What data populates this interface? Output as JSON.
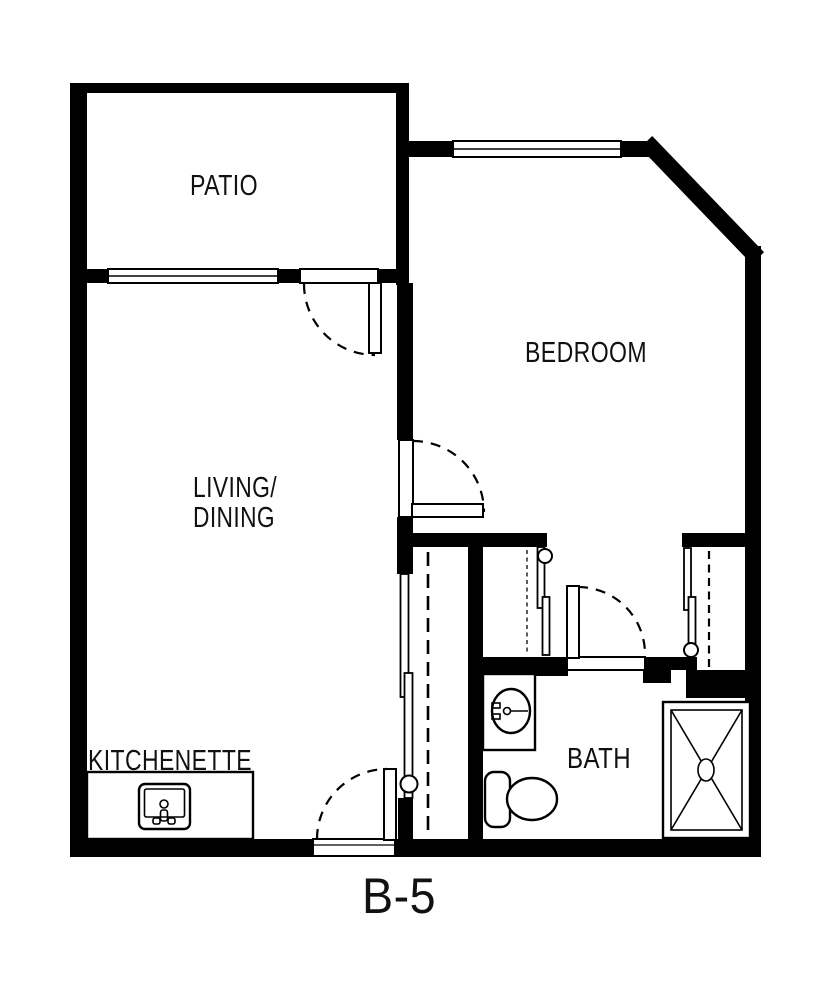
{
  "plan": {
    "unit_label": "B-5",
    "rooms": {
      "patio": "PATIO",
      "bedroom": "BEDROOM",
      "living_line1": "LIVING/",
      "living_line2": "DINING",
      "kitchenette": "KITCHENETTE",
      "bath": "BATH"
    },
    "colors": {
      "walls": "#000000",
      "background": "#ffffff",
      "text": "#111111"
    },
    "fixtures": [
      "kitchen-sink",
      "vanity-sink",
      "toilet",
      "shower",
      "closet-rod"
    ]
  }
}
